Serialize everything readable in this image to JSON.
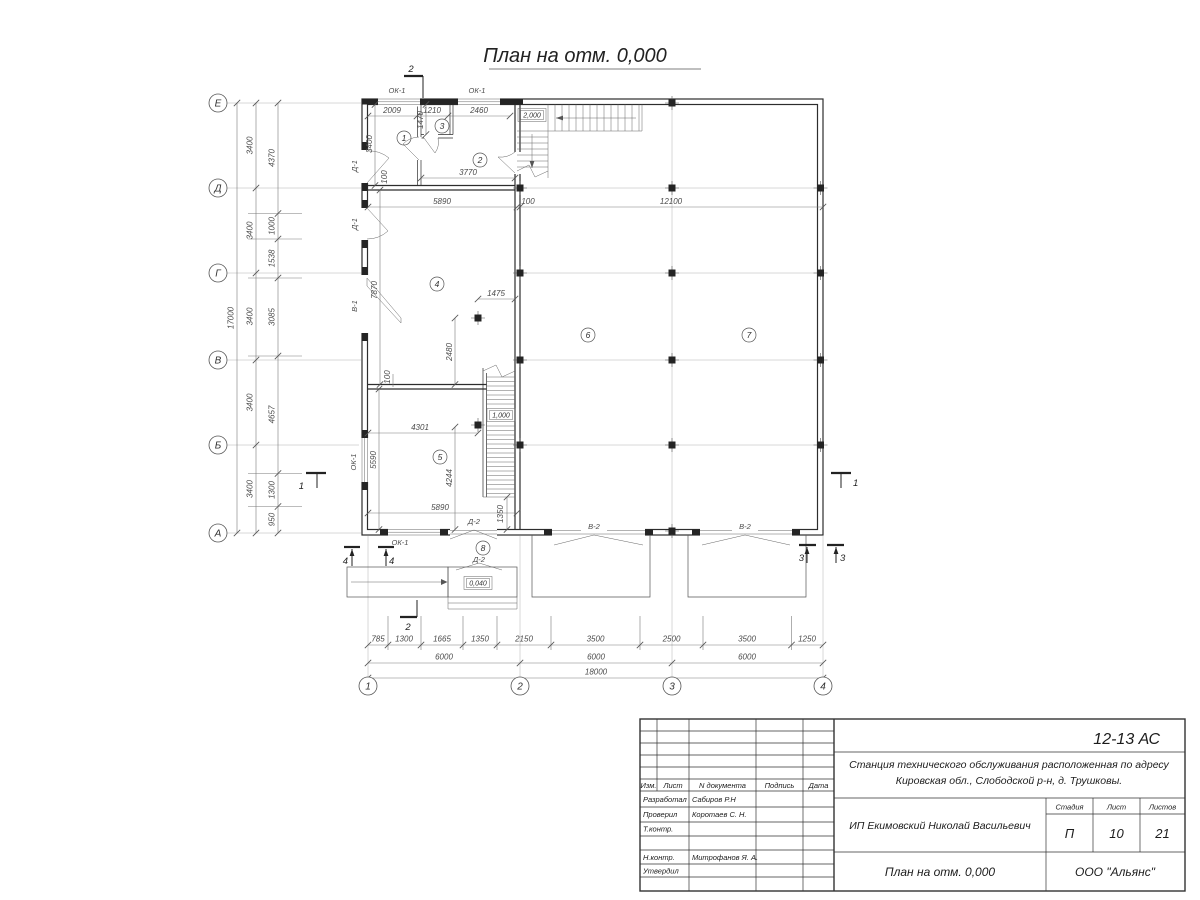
{
  "title": "План на отм. 0,000",
  "axes": {
    "h": [
      "Е",
      "Д",
      "Г",
      "В",
      "Б",
      "А"
    ],
    "v": [
      "1",
      "2",
      "3",
      "4"
    ]
  },
  "dims": {
    "left_total": "17000",
    "left_main": [
      "3400",
      "3400",
      "3400",
      "3400",
      "3400"
    ],
    "left_detail": [
      "4370",
      "1000",
      "1538",
      "3085",
      "4657",
      "1300",
      "950"
    ],
    "bottom_detail": [
      "785",
      "1300",
      "1665",
      "1350",
      "2150",
      "3500",
      "2500",
      "3500",
      "1250"
    ],
    "bottom_main": [
      "6000",
      "6000",
      "6000"
    ],
    "bottom_total": "18000",
    "top_rooms": [
      "2009",
      "1210",
      "2460"
    ],
    "room3_depth": "1470",
    "room1_height": "3400",
    "room2_width": "3770",
    "pier_offset": "100",
    "mid_chain": [
      "5890",
      "100",
      "12100"
    ],
    "room4_height": "7870",
    "col4_dx": "1475",
    "col4_dy": "2480",
    "wall_offset": "100",
    "room5_col_dx": "4301",
    "room5_height": "5590",
    "room5_col_dy": "4244",
    "room5_width": "5890",
    "stair_offset": "1350"
  },
  "rooms": [
    "1",
    "2",
    "3",
    "4",
    "5",
    "6",
    "7",
    "8"
  ],
  "marks": {
    "window1": "ОК-1",
    "door1": "Д-1",
    "door2": "Д-2",
    "gate1": "В-1",
    "gate2": "В-2"
  },
  "elev": {
    "stair_top": "2,000",
    "stair_mid": "1,000",
    "porch": "0,040"
  },
  "sections": {
    "s1": "1",
    "s2": "2",
    "s3": "3",
    "s4": "4"
  },
  "titleblock": {
    "code": "12-13 АС",
    "object_line1": "Станция технического обслуживания расположенная по адресу",
    "object_line2": "Кировская обл., Слободской р-н, д. Трушковы.",
    "client": "ИП Екимовский Николай Васильевич",
    "drawing_name": "План на отм. 0,000",
    "company": "ООО \"Альянс\"",
    "stage_label": "Стадия",
    "sheet_label": "Лист",
    "sheets_label": "Листов",
    "stage": "П",
    "sheet_no": "10",
    "sheets_total": "21",
    "header": {
      "izm": "Изм.",
      "list": "Лист",
      "ndoc": "N документа",
      "podpis": "Подпись",
      "data": "Дата"
    },
    "roles": [
      {
        "role": "Разработал",
        "name": "Сабиров Р.Н"
      },
      {
        "role": "Проверил",
        "name": "Коротаев С. Н."
      },
      {
        "role": "Т.контр.",
        "name": ""
      },
      {
        "role": "",
        "name": ""
      },
      {
        "role": "Н.контр.",
        "name": "Митрофанов Я. А."
      },
      {
        "role": "Утвердил",
        "name": ""
      }
    ]
  }
}
